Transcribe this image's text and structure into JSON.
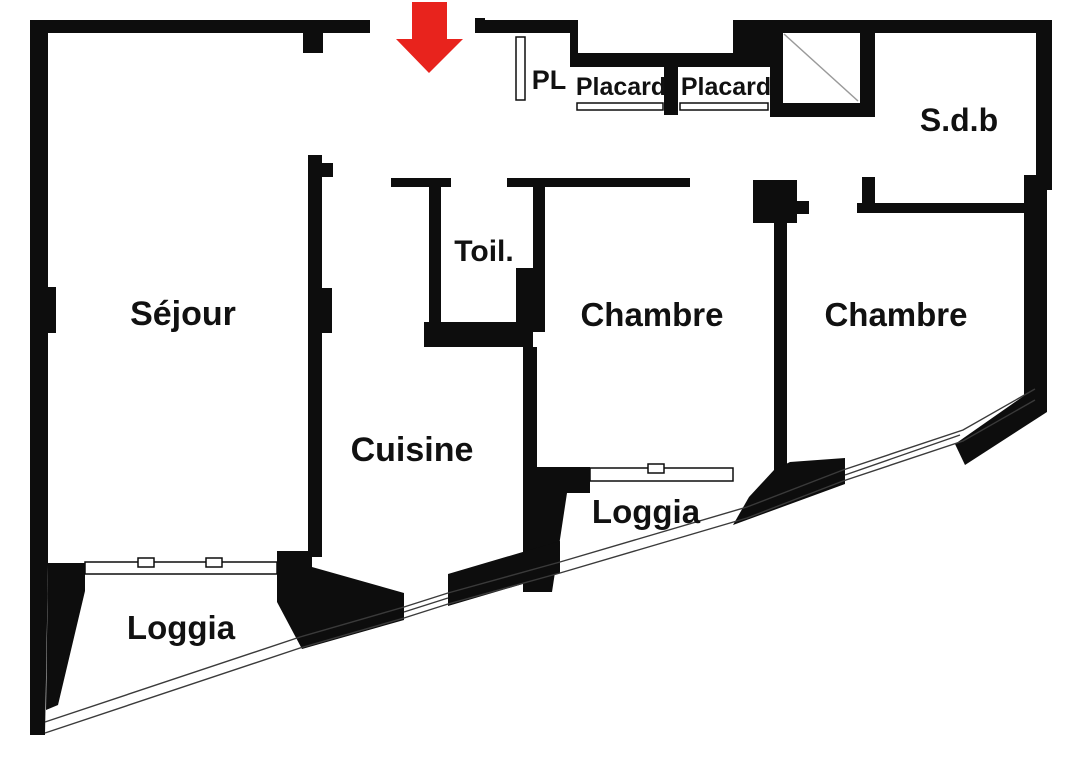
{
  "plan": {
    "type": "apartment-floor-plan",
    "language": "fr"
  },
  "colors": {
    "wall": "#0d0d0d",
    "background": "#ffffff",
    "arrow_red": "#e8231d",
    "shaft_line": "#9a9a9a",
    "railing": "#3a3a3a",
    "label": "#111111"
  },
  "entrance": {
    "arrow_icon": "red-down-arrow"
  },
  "rooms": [
    {
      "id": "sejour",
      "label": "Séjour"
    },
    {
      "id": "cuisine",
      "label": "Cuisine"
    },
    {
      "id": "toilettes",
      "label": "Toil."
    },
    {
      "id": "chambre-1",
      "label": "Chambre"
    },
    {
      "id": "chambre-2",
      "label": "Chambre"
    },
    {
      "id": "sdb",
      "label": "S.d.b"
    },
    {
      "id": "pl",
      "label": "PL"
    },
    {
      "id": "placard-1",
      "label": "Placard"
    },
    {
      "id": "placard-2",
      "label": "Placard"
    },
    {
      "id": "loggia-1",
      "label": "Loggia"
    },
    {
      "id": "loggia-2",
      "label": "Loggia"
    }
  ]
}
